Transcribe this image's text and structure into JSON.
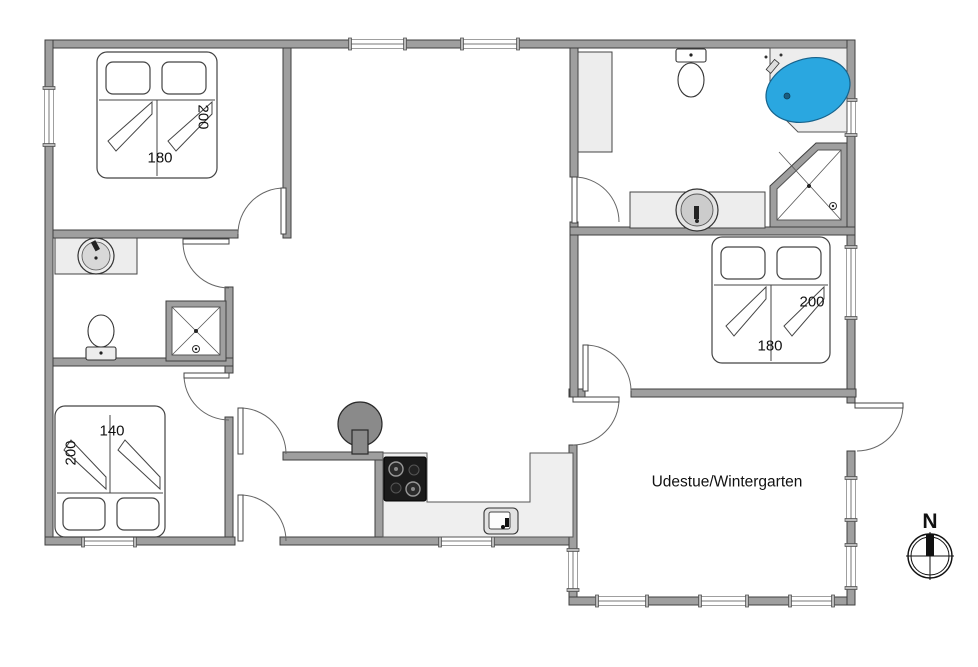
{
  "plan": {
    "rooms": {
      "bedroom_top_left": {
        "bed_width": "180",
        "bed_length": "200"
      },
      "bedroom_right": {
        "bed_width": "180",
        "bed_length": "200"
      },
      "bedroom_bottom_left": {
        "bed_width": "140",
        "bed_length": "200"
      },
      "conservatory": {
        "label": "Udestue/Wintergarten"
      }
    },
    "compass": {
      "north_label": "N"
    },
    "colors": {
      "wall_gray": "#9f9f9f",
      "fixture_gray": "#ededed",
      "bathtub_blue": "#2aa7e0",
      "stove_gray": "#8a8a8a",
      "cooktop_black": "#1b1b1b"
    }
  }
}
